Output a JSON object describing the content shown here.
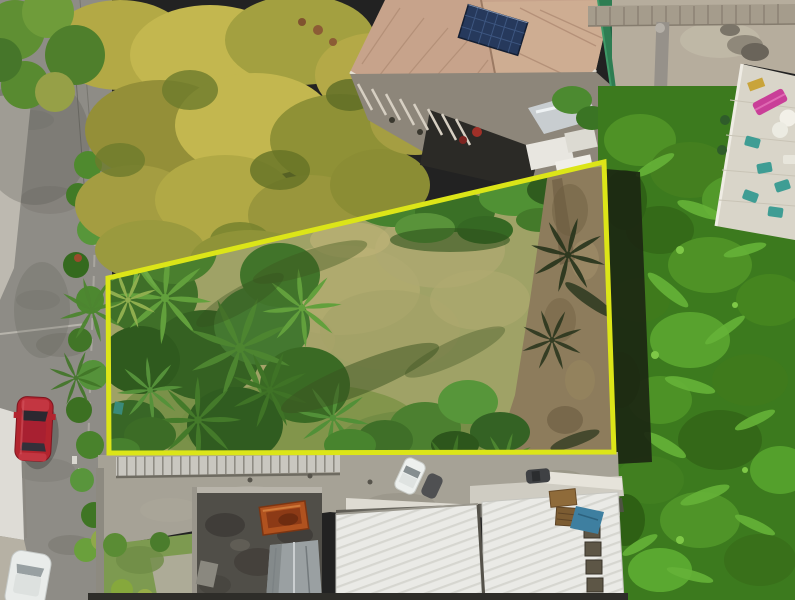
{
  "scene": {
    "type": "aerial-drone-photo",
    "alt_text": "Top-down aerial photo of a vacant residential land parcel outlined with a yellow boundary rectangle; palm trees and a dry lawn inside the parcel, a road with a parked red car on the left, a house with a solar panel at top, a rooftop terrace with a pink sun lounger at top right, dense tropical vegetation on the right, and white and dark rooftops along the bottom",
    "parcel": {
      "outline_points": "108,278 604,162 614,452 109,453",
      "outline_color": "#dce518",
      "outline_width": "5"
    },
    "palette": {
      "road": "#8e8c86",
      "sidewalk": "#bdb9b0",
      "wall_white": "#dedcd6",
      "gravel": "#b6b1a4",
      "canopy_yellow": "#b3a945",
      "canopy_light": "#c3b74f",
      "canopy_olive": "#8f9136",
      "lawn": "#9fa266",
      "lawn_light": "#b2ab70",
      "lawn_green": "#7e9448",
      "palm_mid": "#4d8530",
      "palm_light": "#62a03c",
      "palm_dark": "#3f7326",
      "veg_base": "#3c7a1e",
      "veg_light": "#4f9226",
      "dirt": "#8d7c5c",
      "shadow_band": "#1c2712",
      "roof_tan": "#c7a38b",
      "solar_blue": "#26395c",
      "deck": "#8d867a",
      "shade_cloth": "#2e7d52",
      "courtyard": "#b6ad9d",
      "terrace": "#d9d5c9",
      "lounger_pink": "#c93f98",
      "chair_teal": "#3f9d94",
      "driveway": "#a6a296",
      "fence_band": "#c9c7c0",
      "dark_roof": "#504e48",
      "tank_orange": "#b0521f",
      "metal_gray": "#9aa0a2",
      "white_roof": "#eaeae6",
      "skylight": "#5d5646",
      "car_red": "#b2242e",
      "car_white": "#e9ecea",
      "grass_strip": "#7d9a50",
      "tarp_blue": "#3e7fa0",
      "crate_brown": "#8f6b3a",
      "bottom_edge": "#2e2d29"
    }
  }
}
